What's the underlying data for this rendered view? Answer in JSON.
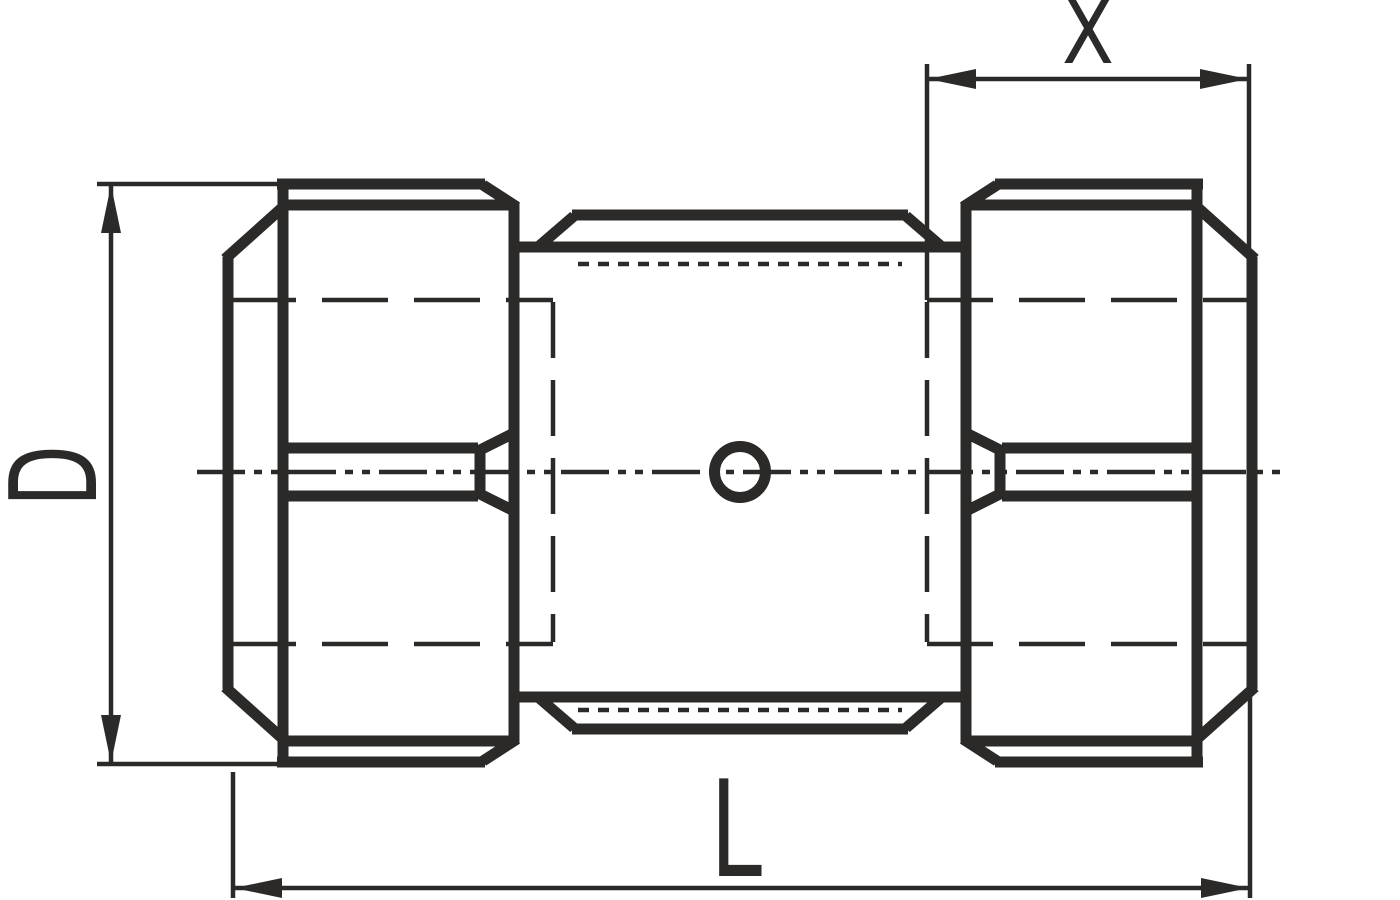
{
  "drawing": {
    "dimension_labels": {
      "diameter": "D",
      "overall_length": "L",
      "insertion_depth": "X"
    },
    "colors": {
      "ink": "#2b2a29",
      "background": "#ffffff"
    }
  }
}
